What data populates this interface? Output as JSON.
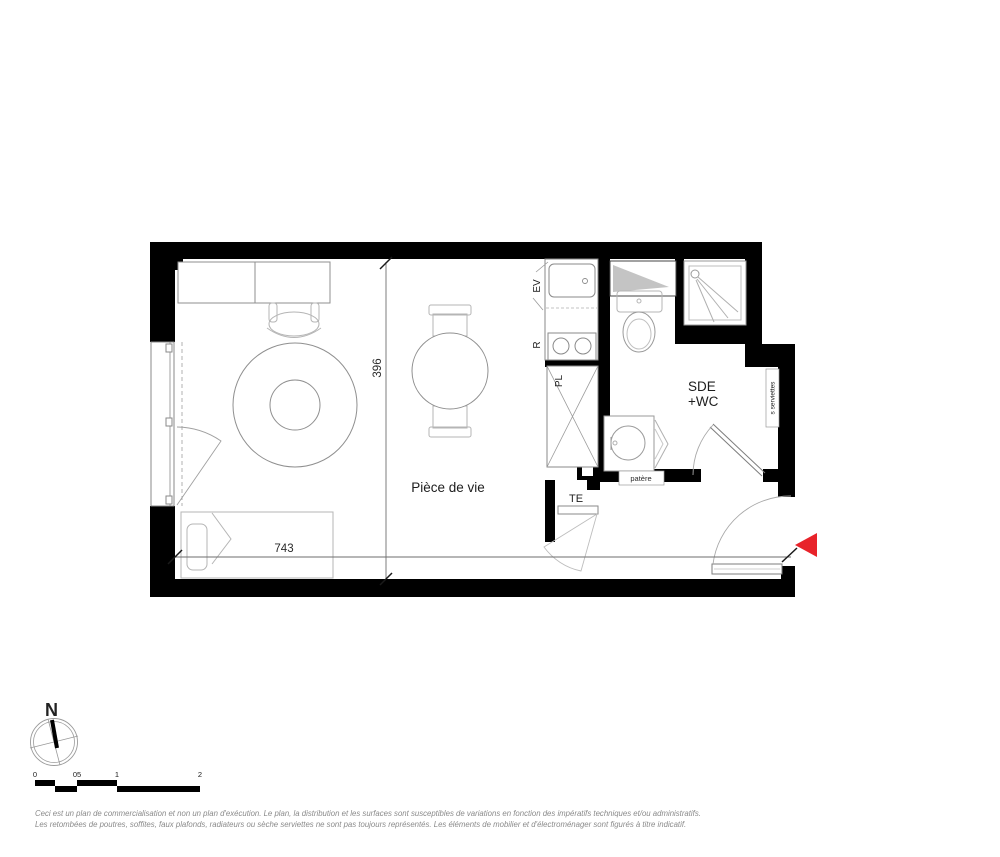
{
  "plan": {
    "rooms": {
      "living_room": "Pièce de vie",
      "bathroom_line1": "SDE",
      "bathroom_line2": "+WC"
    },
    "fixtures": {
      "sink_label": "EV",
      "fridge_label": "R",
      "closet_label": "PL",
      "electrical_label": "TE",
      "coat_hook_label": "patère",
      "towel_dryer_label": "s serviettes"
    },
    "dimensions": {
      "width": "743",
      "height": "396"
    }
  },
  "compass": {
    "north": "N"
  },
  "scale_bar": {
    "ticks": [
      "0",
      "05",
      "1",
      "2"
    ]
  },
  "disclaimer": {
    "line1": "Ceci est un plan de commercialisation et non un plan d'exécution. Le plan, la distribution et les surfaces sont susceptibles de variations en fonction des impératifs techniques et/ou administratifs.",
    "line2": "Les retombées de poutres, soffites, faux plafonds, radiateurs ou sèche serviettes ne sont pas toujours représentés. Les éléments de mobilier et d'électroménager sont figurés à titre indicatif."
  },
  "colors": {
    "wall": "#000000",
    "furniture_line": "#9a9a9a",
    "accent_arrow": "#e8232a"
  }
}
